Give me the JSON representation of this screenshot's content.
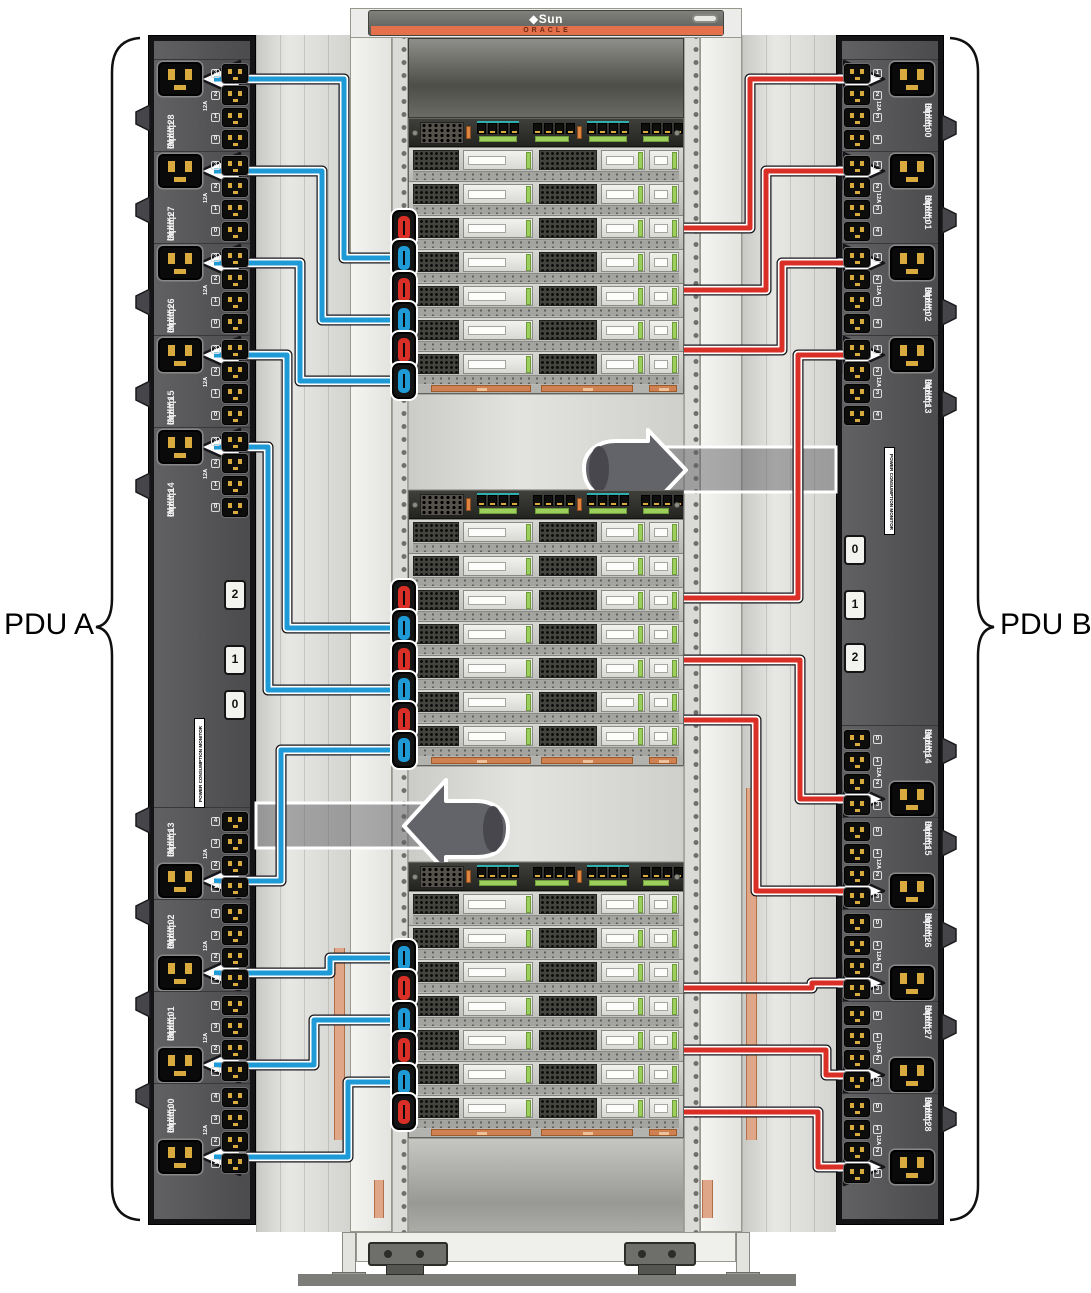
{
  "labels": {
    "pdu_a": "PDU A",
    "pdu_b": "PDU B"
  },
  "rack": {
    "logo_symbol": "◆",
    "logo_text": "Sun",
    "brand_strip": "ORACLE"
  },
  "pdu_a": {
    "name": "PDU A",
    "monitor_label": "POWER CONSUMPTION MONITOR",
    "breakers": [
      "2",
      "1",
      "0"
    ],
    "groups": [
      {
        "input": "Input 2",
        "group": "Group 8",
        "max": "16A MAX",
        "amps": "12A",
        "outlets": [
          "3",
          "2",
          "1",
          "0"
        ]
      },
      {
        "input": "Input 2",
        "group": "Group 7",
        "max": "14A MAX",
        "amps": "12A",
        "outlets": [
          "3",
          "2",
          "1",
          "0"
        ]
      },
      {
        "input": "Input 2",
        "group": "Group 6",
        "max": "14A MAX",
        "amps": "12A",
        "outlets": [
          "3",
          "2",
          "1",
          "0"
        ]
      },
      {
        "input": "Input 1",
        "group": "Group 5",
        "max": "14A MAX",
        "amps": "12A",
        "outlets": [
          "3",
          "2",
          "1",
          "0"
        ]
      },
      {
        "input": "Input 1",
        "group": "Group 4",
        "max": "14A MAX",
        "amps": "12A",
        "outlets": [
          "3",
          "2",
          "1",
          "0"
        ]
      },
      {
        "input": "Input 1",
        "group": "Group 3",
        "max": "14A MAX",
        "amps": "12A",
        "outlets": [
          "4",
          "3",
          "2",
          "1"
        ]
      },
      {
        "input": "Input 0",
        "group": "Group 2",
        "max": "14A MAX",
        "amps": "12A",
        "outlets": [
          "4",
          "3",
          "2",
          "1"
        ]
      },
      {
        "input": "Input 0",
        "group": "Group 1",
        "max": "14A MAX",
        "amps": "12A",
        "outlets": [
          "4",
          "3",
          "2",
          "1"
        ]
      },
      {
        "input": "Input 0",
        "group": "Group 0",
        "max": "14A MAX",
        "amps": "12A",
        "outlets": [
          "4",
          "3",
          "2",
          "1"
        ]
      }
    ]
  },
  "pdu_b": {
    "name": "PDU B",
    "monitor_label": "POWER CONSUMPTION MONITOR",
    "breakers": [
      "0",
      "1",
      "2"
    ],
    "groups": [
      {
        "input": "Input 0",
        "group": "Group 0",
        "max": "14A MAX",
        "amps": "12A",
        "outlets": [
          "1",
          "2",
          "3",
          "4"
        ]
      },
      {
        "input": "Input 0",
        "group": "Group 1",
        "max": "14A MAX",
        "amps": "12A",
        "outlets": [
          "1",
          "2",
          "3",
          "4"
        ]
      },
      {
        "input": "Input 0",
        "group": "Group 2",
        "max": "14A MAX",
        "amps": "12A",
        "outlets": [
          "1",
          "2",
          "3",
          "4"
        ]
      },
      {
        "input": "Input 1",
        "group": "Group 3",
        "max": "14A MAX",
        "amps": "12A",
        "outlets": [
          "1",
          "2",
          "3",
          "4"
        ]
      },
      {
        "input": "Input 1",
        "group": "Group 4",
        "max": "14A MAX",
        "amps": "12A",
        "outlets": [
          "0",
          "1",
          "2",
          "3"
        ]
      },
      {
        "input": "Input 1",
        "group": "Group 5",
        "max": "14A MAX",
        "amps": "12A",
        "outlets": [
          "0",
          "1",
          "2",
          "3"
        ]
      },
      {
        "input": "Input 2",
        "group": "Group 6",
        "max": "14A MAX",
        "amps": "12A",
        "outlets": [
          "0",
          "1",
          "2",
          "3"
        ]
      },
      {
        "input": "Input 2",
        "group": "Group 7",
        "max": "14A MAX",
        "amps": "12A",
        "outlets": [
          "0",
          "1",
          "2",
          "3"
        ]
      },
      {
        "input": "Input 2",
        "group": "Group 8",
        "max": "16A MAX",
        "amps": "12A",
        "outlets": [
          "0",
          "1",
          "2",
          "3"
        ]
      }
    ]
  },
  "cables": {
    "pdu_a_color": "#1e9ad6",
    "pdu_b_color": "#d92f26",
    "connections": [
      {
        "pdu": "A",
        "group": "Group 8",
        "shelf": 1,
        "plug": 1
      },
      {
        "pdu": "A",
        "group": "Group 7",
        "shelf": 1,
        "plug": 2
      },
      {
        "pdu": "A",
        "group": "Group 6",
        "shelf": 1,
        "plug": 3
      },
      {
        "pdu": "A",
        "group": "Group 5",
        "shelf": 2,
        "plug": 1
      },
      {
        "pdu": "A",
        "group": "Group 4",
        "shelf": 2,
        "plug": 2
      },
      {
        "pdu": "A",
        "group": "Group 3",
        "shelf": 2,
        "plug": 3
      },
      {
        "pdu": "A",
        "group": "Group 2",
        "shelf": 3,
        "plug": 1
      },
      {
        "pdu": "A",
        "group": "Group 1",
        "shelf": 3,
        "plug": 2
      },
      {
        "pdu": "A",
        "group": "Group 0",
        "shelf": 3,
        "plug": 3
      },
      {
        "pdu": "B",
        "group": "Group 0",
        "shelf": 1,
        "plug": 1
      },
      {
        "pdu": "B",
        "group": "Group 1",
        "shelf": 1,
        "plug": 2
      },
      {
        "pdu": "B",
        "group": "Group 2",
        "shelf": 1,
        "plug": 3
      },
      {
        "pdu": "B",
        "group": "Group 3",
        "shelf": 2,
        "plug": 1
      },
      {
        "pdu": "B",
        "group": "Group 4",
        "shelf": 2,
        "plug": 2
      },
      {
        "pdu": "B",
        "group": "Group 5",
        "shelf": 2,
        "plug": 3
      },
      {
        "pdu": "B",
        "group": "Group 6",
        "shelf": 3,
        "plug": 1
      },
      {
        "pdu": "B",
        "group": "Group 7",
        "shelf": 3,
        "plug": 2
      },
      {
        "pdu": "B",
        "group": "Group 8",
        "shelf": 3,
        "plug": 3
      }
    ]
  }
}
